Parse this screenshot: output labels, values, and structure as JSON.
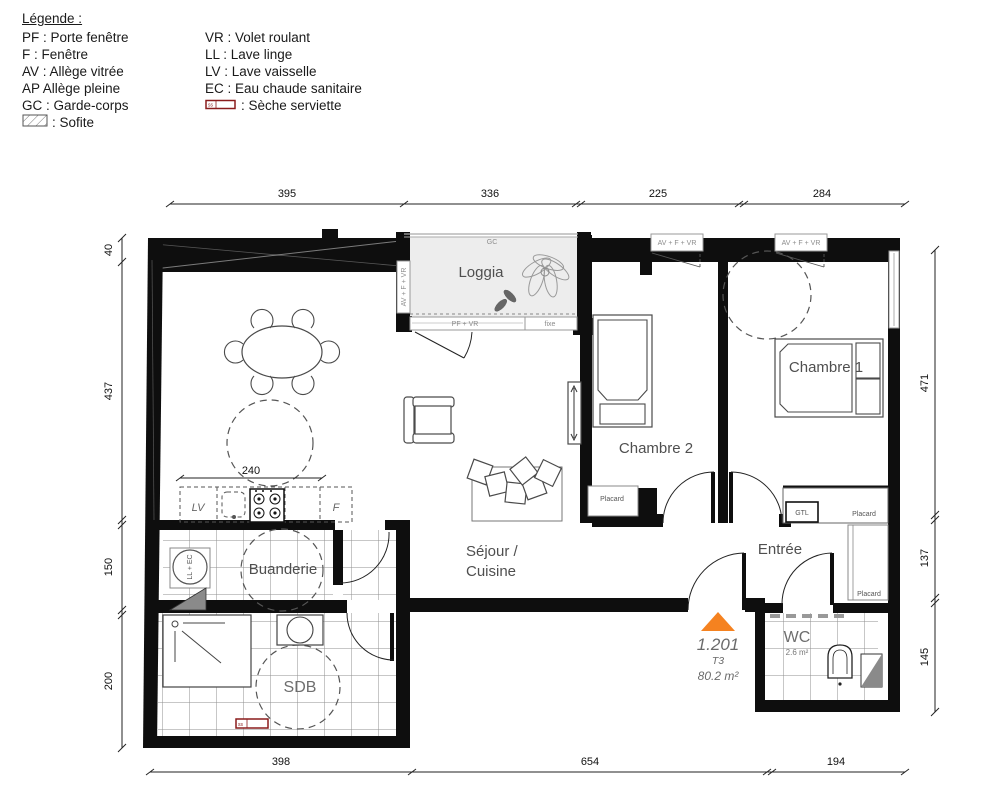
{
  "legend": {
    "title": "Légende :",
    "col1": [
      "PF : Porte fenêtre",
      "F : Fenêtre",
      "AV : Allège vitrée",
      "AP Allège pleine",
      "GC : Garde-corps"
    ],
    "col2": [
      "VR : Volet roulant",
      "LL : Lave linge",
      "LV :  Lave vaisselle",
      "EC :  Eau chaude sanitaire"
    ],
    "sofite": ": Sofite",
    "seche": ": Sèche serviette",
    "seche_box": "ss"
  },
  "unit": {
    "number": "1.201",
    "type": "T3",
    "area": "80.2 m²"
  },
  "rooms": {
    "loggia": "Loggia",
    "sejour_line1": "Séjour /",
    "sejour_line2": "Cuisine",
    "chambre1": "Chambre 1",
    "chambre2": "Chambre 2",
    "buanderie": "Buanderie",
    "sdb": "SDB",
    "entree": "Entrée",
    "wc": "WC",
    "wc_area": "2.6 m²"
  },
  "fixtures": {
    "gc": "GC",
    "pf_vr": "PF + VR",
    "fixe": "fixe",
    "av_f_vr": "AV + F + VR",
    "lv": "LV",
    "f": "F",
    "ll_ec": "LL + EC",
    "gtl": "GTL",
    "placard": "Placard",
    "ss": "ss"
  },
  "dims": {
    "top": [
      "395",
      "336",
      "225",
      "284"
    ],
    "left": [
      "40",
      "437",
      "150",
      "200"
    ],
    "right": [
      "471",
      "137",
      "145"
    ],
    "bottom": [
      "398",
      "654",
      "194"
    ],
    "kitchen": "240"
  },
  "colors": {
    "entrance_marker": "#F58220",
    "seche_serviette": "#8A1C1C",
    "wall": "#0E0E0E"
  }
}
